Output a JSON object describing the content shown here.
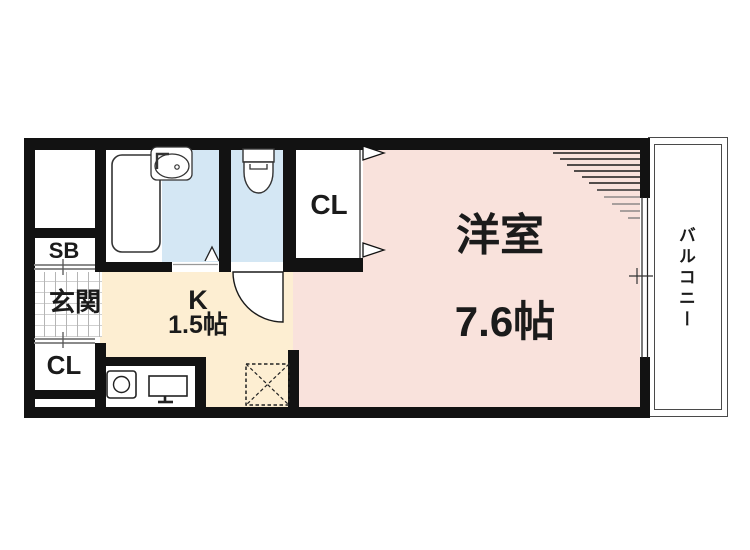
{
  "rooms": {
    "western": {
      "label": "洋室",
      "size": "7.6帖"
    },
    "kitchen": {
      "label": "K",
      "size": "1.5帖"
    },
    "entrance": {
      "label": "玄関"
    },
    "balcony": {
      "label": "バルコニー"
    },
    "closet_main": {
      "label": "CL"
    },
    "closet_entrance": {
      "label": "CL"
    },
    "shoe_box": {
      "label": "SB"
    }
  },
  "colors": {
    "room_pink": "#f9e2dc",
    "kitchen_cream": "#fdeed2",
    "wet_area_blue": "#d4e7f4",
    "wall_black": "#121212",
    "line_grey": "#8a8a8a"
  },
  "icons": {
    "bathtub": "bathtub-icon",
    "wash_basin": "wash-basin-icon",
    "toilet": "toilet-icon",
    "stove": "stove-burner-icon",
    "kitchen_sink": "kitchen-sink-icon",
    "refrigerator_space": "refrigerator-space-icon",
    "toilet_door_swing": "door-swing-icon",
    "bath_folding_door": "folding-door-icon",
    "closet_doors": "closet-door-arrows-icon",
    "window": "sliding-window-icon"
  }
}
